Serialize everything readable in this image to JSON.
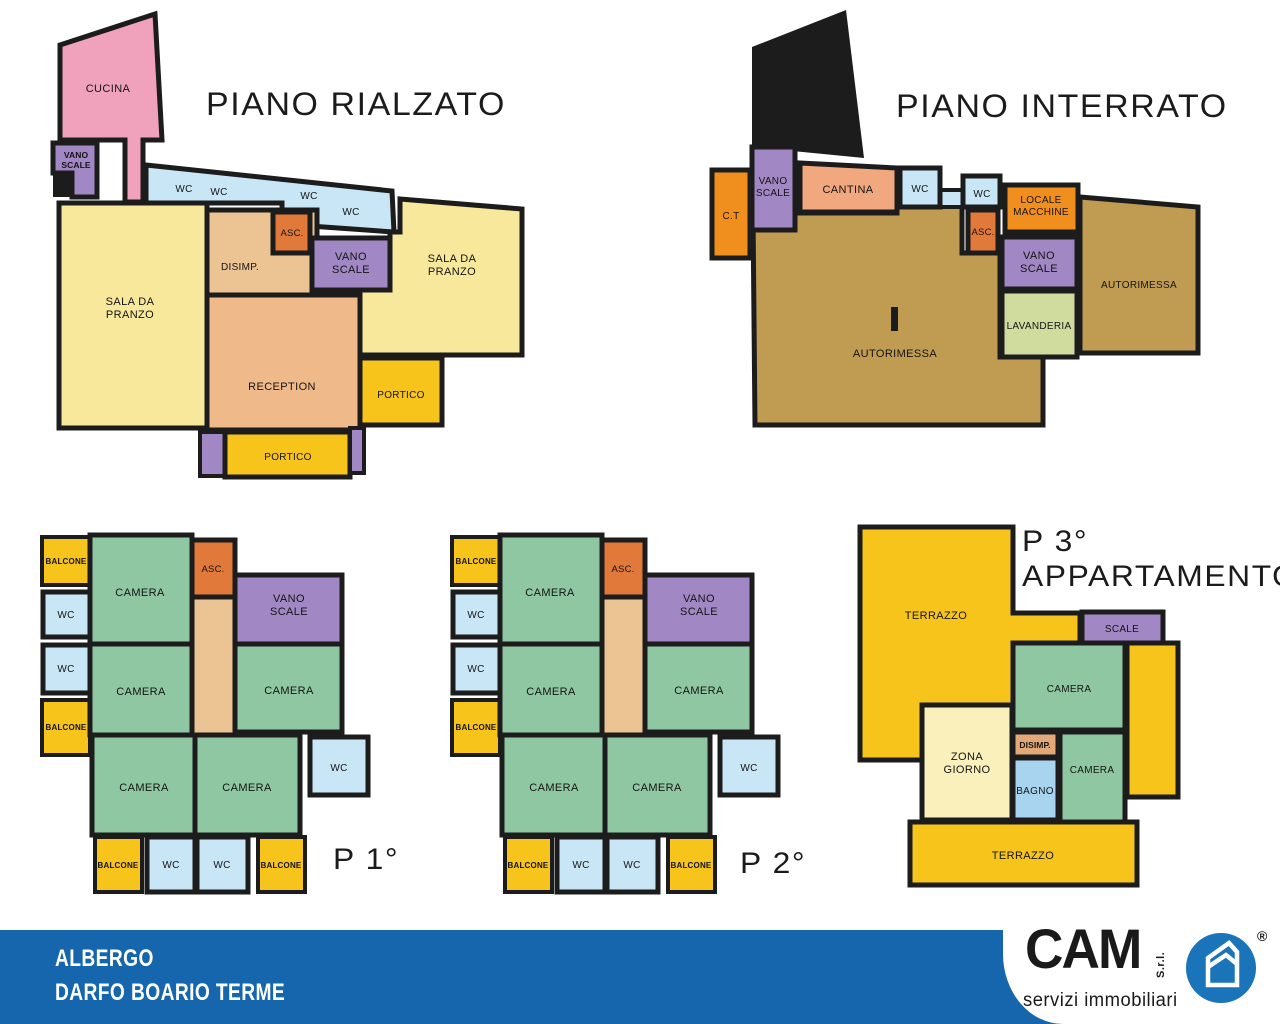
{
  "colors": {
    "wall": "#1c1c1c",
    "camera": "#8fc7a3",
    "wc": "#c9e6f7",
    "bagno": "#a9d4ef",
    "gold": "#f6c41a",
    "purple": "#a287c5",
    "asc_orange": "#e0793a",
    "corridor": "#ecc392",
    "reception": "#f0b98a",
    "disimp_dark": "#e2a877",
    "sala": "#f8e89c",
    "zona_giorno": "#f9f0bc",
    "cucina_pink": "#f0a2bd",
    "cantina": "#f2a87e",
    "autorimessa": "#c09c52",
    "lavanderia": "#cfdc9e",
    "bright_orange": "#f08f1d",
    "footer_blue": "#1666ad",
    "logo_blue": "#1a74ba"
  },
  "floors": {
    "piano_rialzato": {
      "title": "PIANO RIALZATO",
      "rooms": {
        "cucina": "CUCINA",
        "vano_scale_upper": "VANO\nSCALE",
        "wc1": "WC",
        "wc2": "WC",
        "wc3": "WC",
        "wc4": "WC",
        "sala_sx": "SALA DA\nPRANZO",
        "disimp": "DISIMP.",
        "asc": "ASC.",
        "vano_scale": "VANO\nSCALE",
        "sala_dx": "SALA DA\nPRANZO",
        "reception": "RECEPTION",
        "portico_dx": "PORTICO",
        "portico_sud": "PORTICO"
      }
    },
    "piano_interrato": {
      "title": "PIANO INTERRATO",
      "rooms": {
        "ct": "C.T",
        "vano_scale_upper": "VANO\nSCALE",
        "cantina": "CANTINA",
        "wc1": "WC",
        "wc2": "WC",
        "locale_macchine": "LOCALE\nMACCHINE",
        "asc": "ASC.",
        "vano_scale": "VANO\nSCALE",
        "lavanderia": "LAVANDERIA",
        "autorimessa_dx": "AUTORIMESSA",
        "autorimessa": "AUTORIMESSA"
      }
    },
    "p1": {
      "label": "P 1°",
      "rooms": {
        "balcone_tl": "BALCONE",
        "camera_tl": "CAMERA",
        "asc": "ASC.",
        "vano_scale": "VANO\nSCALE",
        "wc_l1": "WC",
        "wc_l2": "WC",
        "balcone_l": "BALCONE",
        "camera_ml": "CAMERA",
        "camera_mr": "CAMERA",
        "camera_bl": "CAMERA",
        "camera_br": "CAMERA",
        "wc_r": "WC",
        "balcone_b1": "BALCONE",
        "wc_b1": "WC",
        "wc_b2": "WC",
        "balcone_b2": "BALCONE"
      }
    },
    "p2": {
      "label": "P 2°",
      "rooms": {
        "balcone_tl": "BALCONE",
        "camera_tl": "CAMERA",
        "asc": "ASC.",
        "vano_scale": "VANO\nSCALE",
        "wc_l1": "WC",
        "wc_l2": "WC",
        "balcone_l": "BALCONE",
        "camera_ml": "CAMERA",
        "camera_mr": "CAMERA",
        "camera_bl": "CAMERA",
        "camera_br": "CAMERA",
        "wc_r": "WC",
        "balcone_b1": "BALCONE",
        "wc_b1": "WC",
        "wc_b2": "WC",
        "balcone_b2": "BALCONE"
      }
    },
    "p3": {
      "title_line1": "P 3°",
      "title_line2": "APPARTAMENTO",
      "rooms": {
        "terrazzo_nord": "TERRAZZO",
        "scale": "SCALE",
        "camera_nord": "CAMERA",
        "zona_giorno": "ZONA\nGIORNO",
        "disimp": "DISIMP.",
        "bagno": "BAGNO",
        "camera_sud": "CAMERA",
        "terrazzo_sud": "TERRAZZO"
      }
    }
  },
  "footer": {
    "line1": "ALBERGO",
    "line2": "DARFO BOARIO TERME",
    "logo": {
      "name": "CAM",
      "suffix": "S.r.l.",
      "registered": "®",
      "tagline": "servizi immobiliari"
    }
  }
}
